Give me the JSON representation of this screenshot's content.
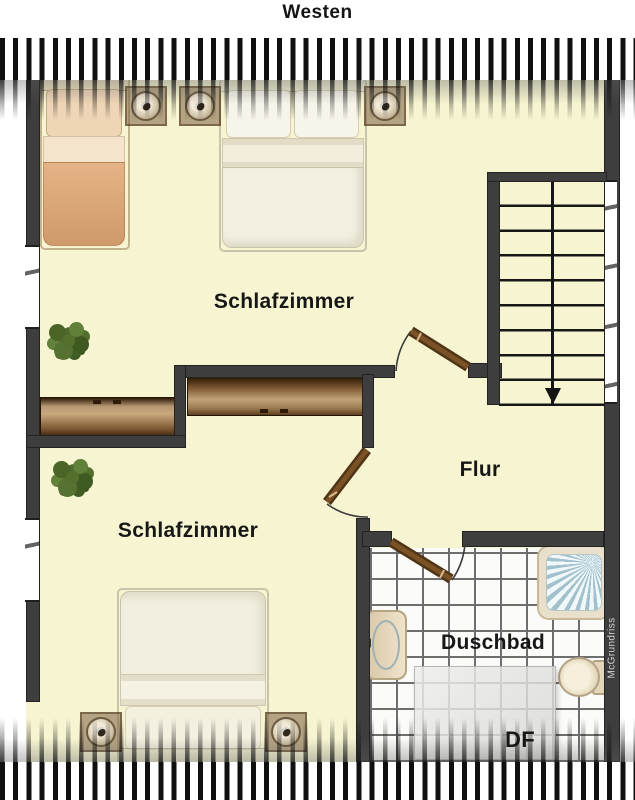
{
  "title": "Westen",
  "rooms": {
    "bedroom_top": "Schlafzimmer",
    "bedroom_bottom": "Schlafzimmer",
    "hallway": "Flur",
    "bathroom": "Duschbad",
    "roof_window": "DF"
  },
  "watermark": "McGrundriss",
  "colors": {
    "floor": "#f7f5d1",
    "wall": "#3e3e3e",
    "hatch": "#101010",
    "door_leaf": "#5a3a18",
    "wardrobe_light": "#c2a277",
    "wardrobe_dark": "#301c06",
    "single_bed_blanket": "#d9a276",
    "double_bed_linen": "#f3f0e1",
    "tile_line": "#6e6e6e",
    "shower_glass": "#e3edf0",
    "plant_green": "#55702c",
    "watermark_text": "#d6d4d2"
  }
}
